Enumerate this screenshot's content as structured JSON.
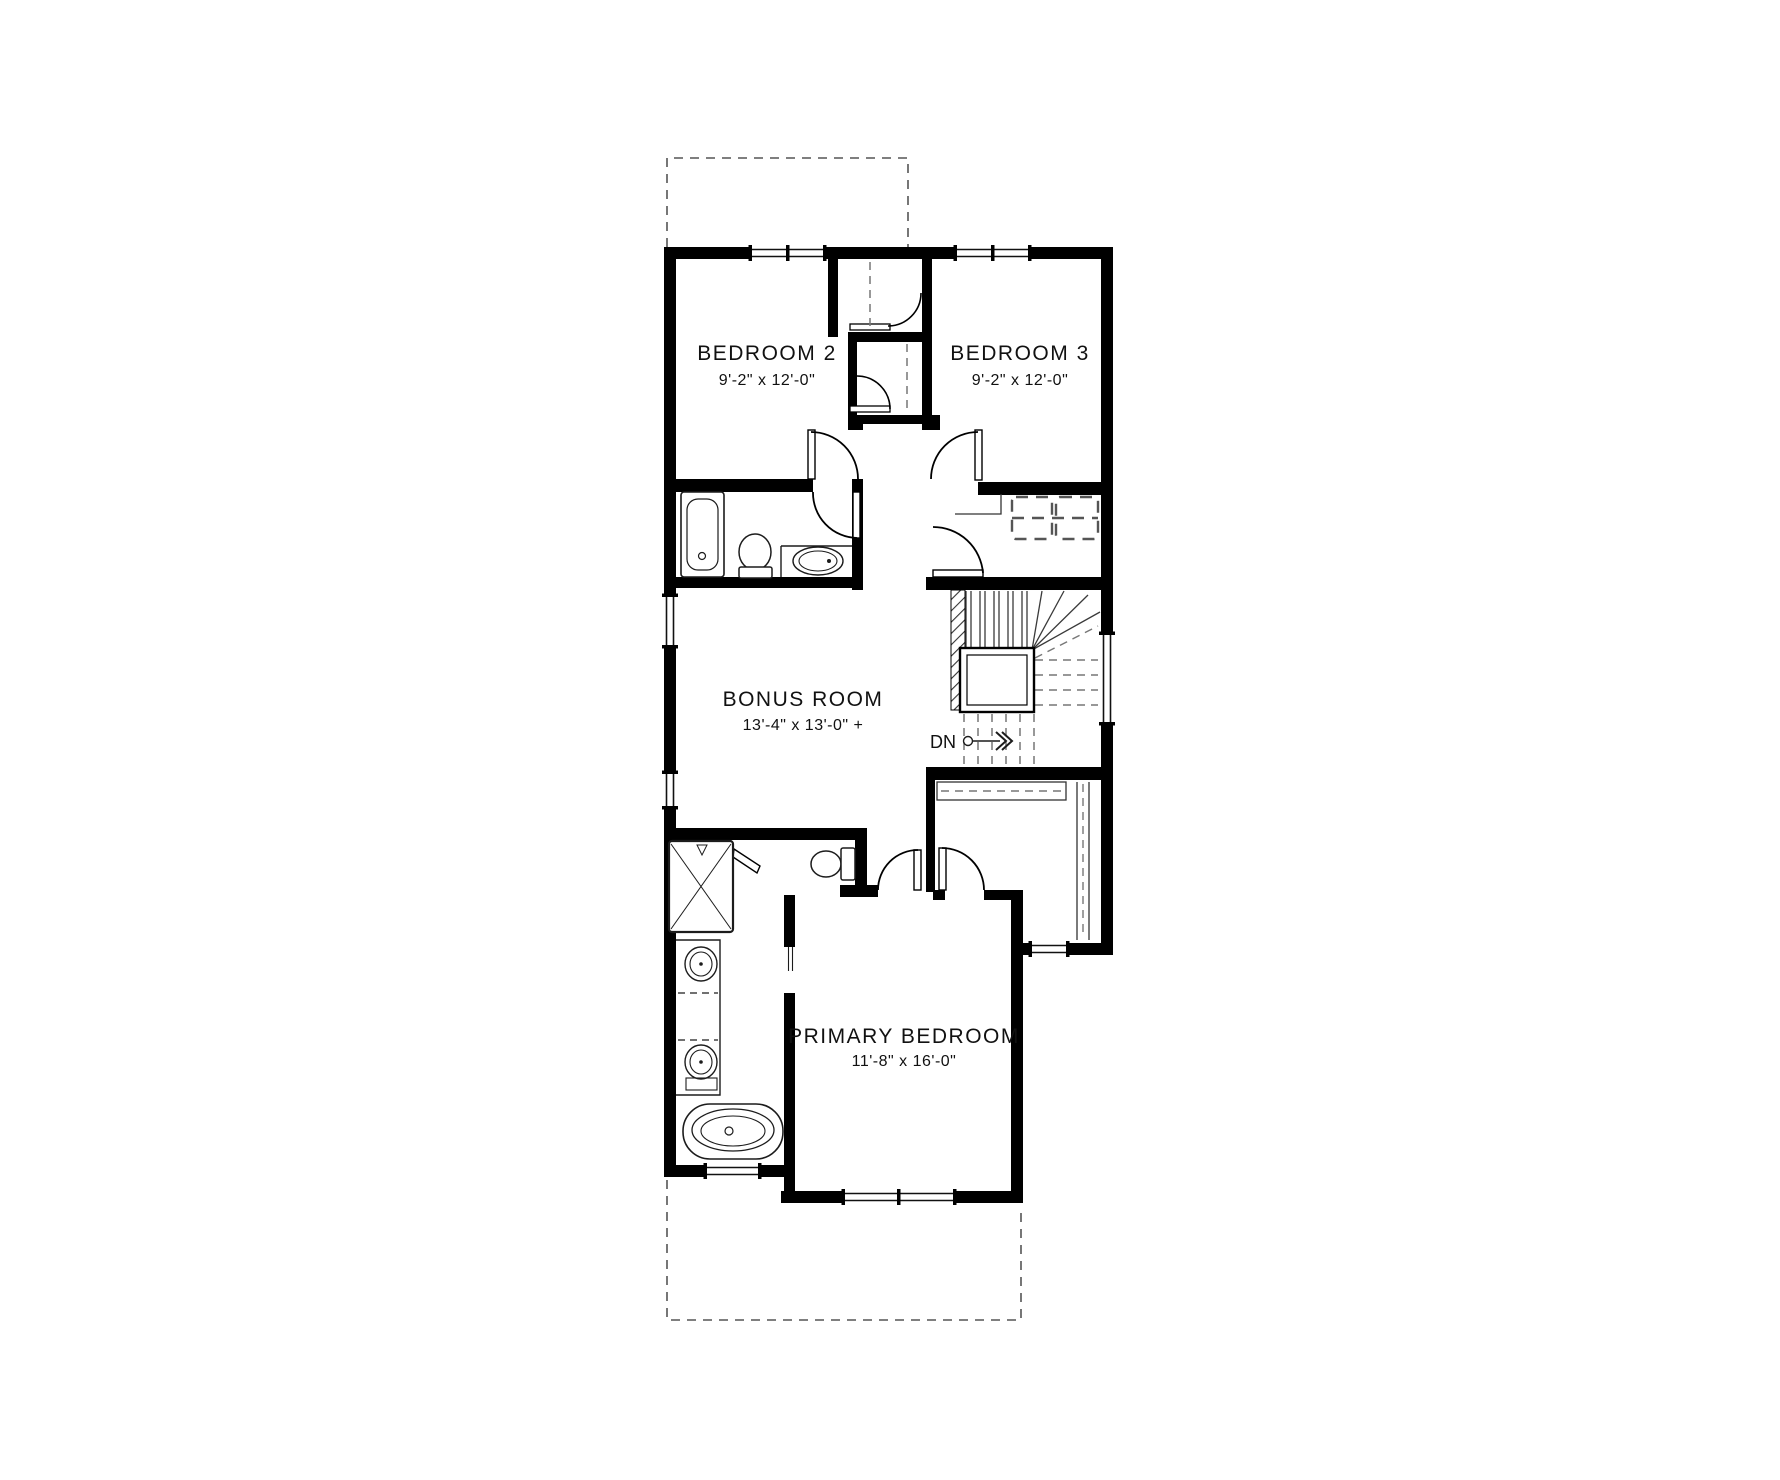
{
  "floor_plan": {
    "rooms": [
      {
        "id": "bedroom-2",
        "name": "BEDROOM  2",
        "dimensions": "9'-2\" x 12'-0\""
      },
      {
        "id": "bedroom-3",
        "name": "BEDROOM  3",
        "dimensions": "9'-2\" x 12'-0\""
      },
      {
        "id": "bonus-room",
        "name": "BONUS ROOM",
        "dimensions": "13'-4\" x 13'-0\" +"
      },
      {
        "id": "primary-bedroom",
        "name": "PRIMARY BEDROOM",
        "dimensions": "11'-8\" x 16'-0\""
      }
    ],
    "stairs": {
      "direction_label": "DN"
    },
    "fixtures": [
      "bathtub",
      "toilet",
      "vanity-sink",
      "washer-dryer",
      "stairs",
      "shower",
      "toilet-ensuite",
      "double-vanity-sinks",
      "freestanding-tub",
      "closet-rods",
      "wardrobe-shelves"
    ],
    "colors": {
      "wall": "#000000",
      "background": "#ffffff",
      "line": "#1c1c1c",
      "dashed_line": "#6a6a6a",
      "text": "#111111"
    }
  }
}
